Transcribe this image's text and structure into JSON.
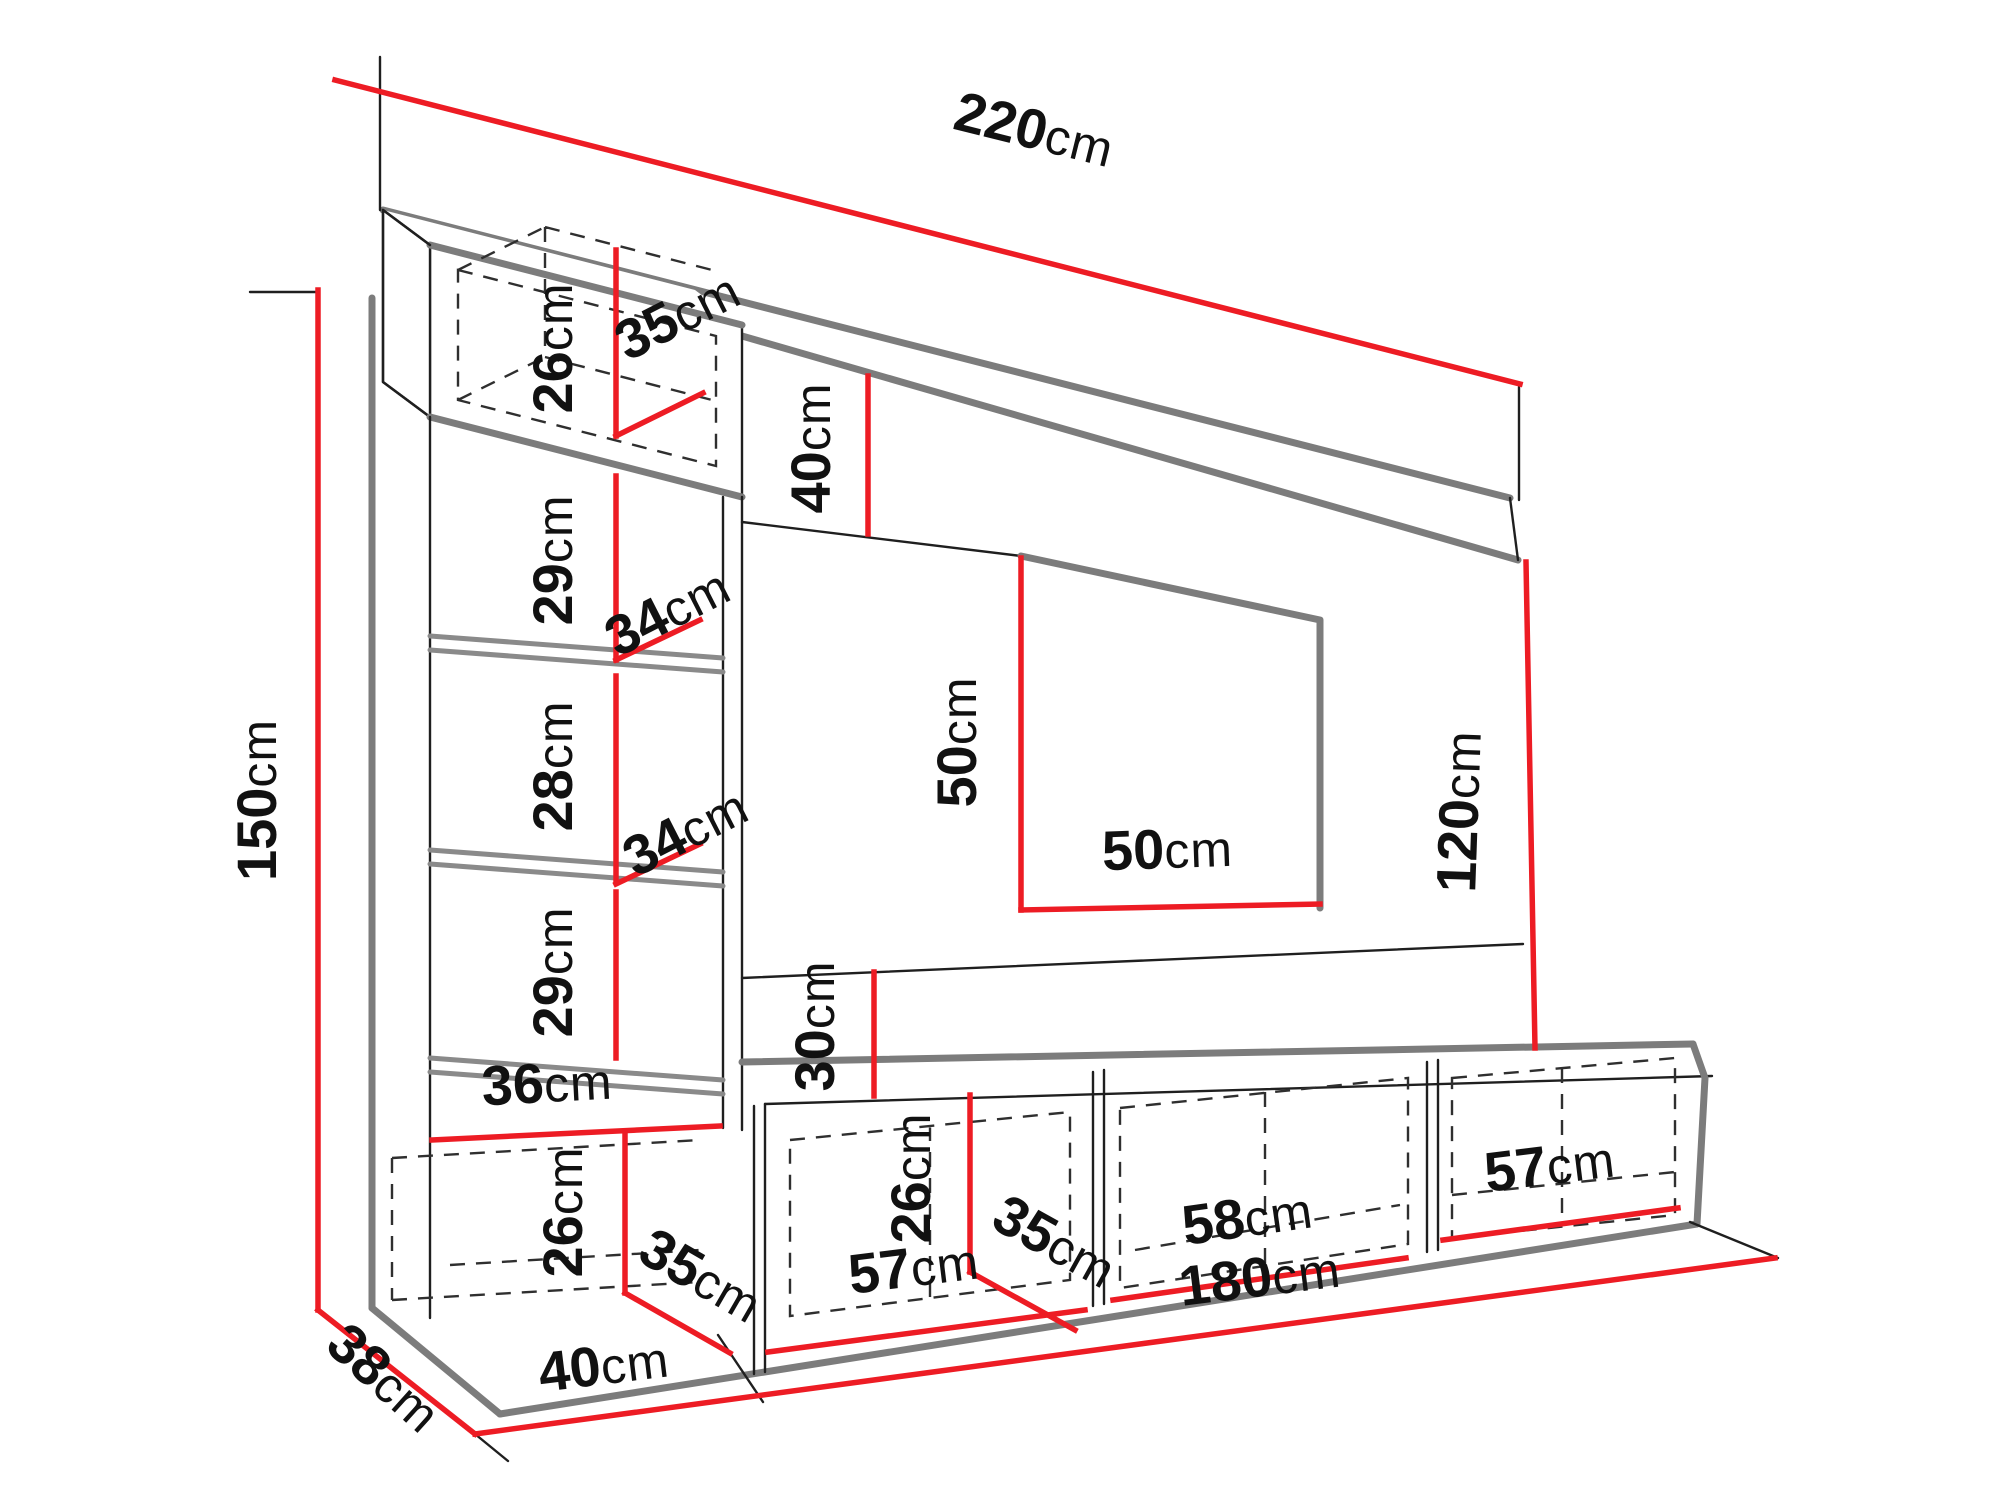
{
  "diagram": {
    "title": "Wall unit furniture dimension diagram",
    "unit": "cm",
    "colors": {
      "dimension_line": "#ed1c24",
      "outline_strong": "#7c7c7c",
      "outline_thin": "#1f1f1f",
      "background": "#ffffff",
      "label_text": "#111111"
    },
    "dimensions": [
      {
        "name": "overall-width",
        "value": "220",
        "unit": "cm"
      },
      {
        "name": "overall-height",
        "value": "150",
        "unit": "cm"
      },
      {
        "name": "top-cabinet-height",
        "value": "26",
        "unit": "cm"
      },
      {
        "name": "top-cabinet-depth",
        "value": "35",
        "unit": "cm"
      },
      {
        "name": "top-panel-gap-height",
        "value": "40",
        "unit": "cm"
      },
      {
        "name": "shelf-opening-1-height",
        "value": "29",
        "unit": "cm"
      },
      {
        "name": "shelf-1-depth",
        "value": "34",
        "unit": "cm"
      },
      {
        "name": "shelf-opening-2-height",
        "value": "28",
        "unit": "cm"
      },
      {
        "name": "shelf-2-depth",
        "value": "34",
        "unit": "cm"
      },
      {
        "name": "shelf-opening-3-height",
        "value": "29",
        "unit": "cm"
      },
      {
        "name": "column-inner-width",
        "value": "36",
        "unit": "cm"
      },
      {
        "name": "left-base-cabinet-height",
        "value": "26",
        "unit": "cm"
      },
      {
        "name": "left-base-cabinet-depth",
        "value": "35",
        "unit": "cm"
      },
      {
        "name": "side-panel-depth",
        "value": "38",
        "unit": "cm"
      },
      {
        "name": "left-base-cabinet-width",
        "value": "40",
        "unit": "cm"
      },
      {
        "name": "back-gap-height",
        "value": "30",
        "unit": "cm"
      },
      {
        "name": "tv-opening-height",
        "value": "50",
        "unit": "cm"
      },
      {
        "name": "tv-opening-width",
        "value": "50",
        "unit": "cm"
      },
      {
        "name": "right-panel-height",
        "value": "120",
        "unit": "cm"
      },
      {
        "name": "base-cabinet-height",
        "value": "26",
        "unit": "cm"
      },
      {
        "name": "base-cabinet-depth",
        "value": "35",
        "unit": "cm"
      },
      {
        "name": "base-cabinet-1-width",
        "value": "57",
        "unit": "cm"
      },
      {
        "name": "base-cabinet-2-width",
        "value": "58",
        "unit": "cm"
      },
      {
        "name": "base-cabinet-3-width",
        "value": "57",
        "unit": "cm"
      },
      {
        "name": "base-row-width",
        "value": "180",
        "unit": "cm"
      }
    ]
  }
}
